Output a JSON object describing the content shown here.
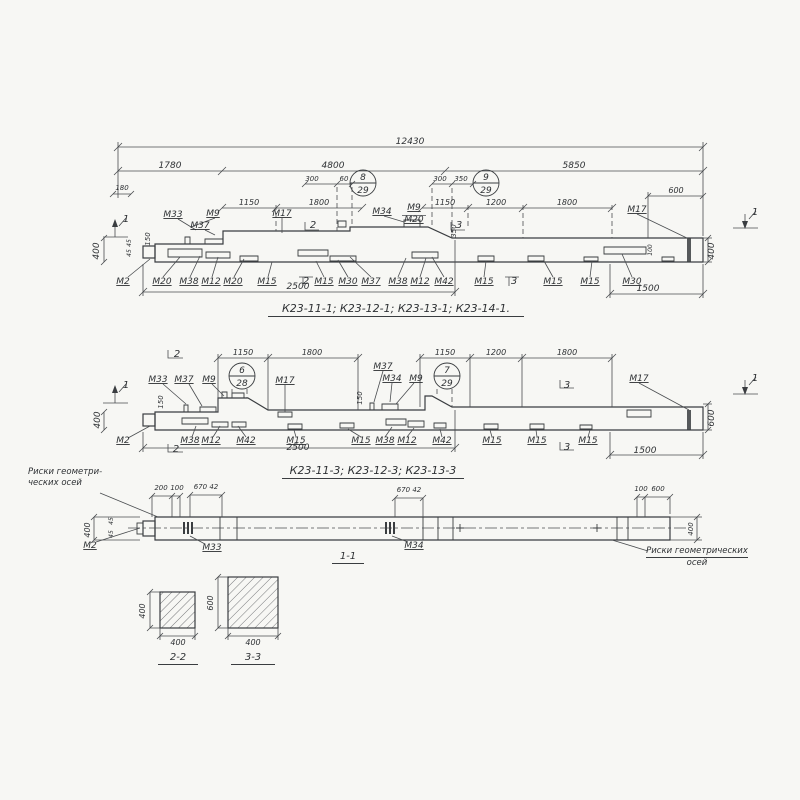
{
  "page": {
    "background": "#f7f7f4",
    "ink": "#3a3d40"
  },
  "captions": {
    "view1": "К23-11-1; К23-12-1; К23-13-1; К23-14-1.",
    "view2": "К23-11-3; К23-12-3; К23-13-3",
    "view3": "1-1",
    "sec2": "2-2",
    "sec3": "3-3"
  },
  "notes": {
    "left1": "Риски геометри-",
    "left2": "ческих осей",
    "right1": "Риски геометрических",
    "right2": "осей"
  },
  "detail_circles": [
    {
      "top": "8",
      "bottom": "29",
      "x": 363,
      "y": 183
    },
    {
      "top": "9",
      "bottom": "29",
      "x": 486,
      "y": 183
    },
    {
      "top": "6",
      "bottom": "28",
      "x": 242,
      "y": 376
    },
    {
      "top": "7",
      "bottom": "29",
      "x": 447,
      "y": 376
    }
  ],
  "labels": [
    {
      "t": "12430",
      "x": 410,
      "y": 144
    },
    {
      "t": "1780",
      "x": 170,
      "y": 168
    },
    {
      "t": "4800",
      "x": 333,
      "y": 168
    },
    {
      "t": "5850",
      "x": 574,
      "y": 168
    },
    {
      "t": "180",
      "x": 122,
      "y": 190,
      "s": 7
    },
    {
      "t": "300",
      "x": 312,
      "y": 181,
      "s": 7
    },
    {
      "t": "60",
      "x": 344,
      "y": 181,
      "s": 7
    },
    {
      "t": "300",
      "x": 440,
      "y": 181,
      "s": 7
    },
    {
      "t": "350",
      "x": 461,
      "y": 181,
      "s": 7
    },
    {
      "t": "1150",
      "x": 249,
      "y": 205,
      "s": 8
    },
    {
      "t": "1800",
      "x": 319,
      "y": 205,
      "s": 8
    },
    {
      "t": "1150",
      "x": 445,
      "y": 205,
      "s": 8
    },
    {
      "t": "1200",
      "x": 496,
      "y": 205,
      "s": 8
    },
    {
      "t": "1800",
      "x": 567,
      "y": 205,
      "s": 8
    },
    {
      "t": "600",
      "x": 676,
      "y": 193,
      "s": 8
    },
    {
      "t": "М33",
      "x": 173,
      "y": 217,
      "u": 1
    },
    {
      "t": "М37",
      "x": 200,
      "y": 228,
      "u": 1
    },
    {
      "t": "М9",
      "x": 213,
      "y": 216,
      "u": 1
    },
    {
      "t": "М17",
      "x": 282,
      "y": 216,
      "u": 1
    },
    {
      "t": "М34",
      "x": 382,
      "y": 214,
      "u": 1
    },
    {
      "t": "М9",
      "x": 414,
      "y": 210,
      "u": 1
    },
    {
      "t": "М20",
      "x": 414,
      "y": 222,
      "u": 1
    },
    {
      "t": "М17",
      "x": 637,
      "y": 212,
      "u": 1
    },
    {
      "t": "2",
      "x": 313,
      "y": 228,
      "s": 10
    },
    {
      "t": "3",
      "x": 459,
      "y": 228,
      "s": 10
    },
    {
      "t": "1",
      "x": 126,
      "y": 222,
      "s": 10
    },
    {
      "t": "1",
      "x": 755,
      "y": 215,
      "s": 10
    },
    {
      "t": "М2",
      "x": 123,
      "y": 284,
      "u": 1
    },
    {
      "t": "М20",
      "x": 162,
      "y": 284,
      "u": 1
    },
    {
      "t": "М38",
      "x": 189,
      "y": 284,
      "u": 1
    },
    {
      "t": "М12",
      "x": 211,
      "y": 284,
      "u": 1
    },
    {
      "t": "М20",
      "x": 233,
      "y": 284,
      "u": 1
    },
    {
      "t": "М15",
      "x": 267,
      "y": 284,
      "u": 1
    },
    {
      "t": "2",
      "x": 306,
      "y": 284,
      "s": 10
    },
    {
      "t": "М15",
      "x": 324,
      "y": 284,
      "u": 1
    },
    {
      "t": "М30",
      "x": 348,
      "y": 284,
      "u": 1
    },
    {
      "t": "М37",
      "x": 371,
      "y": 284,
      "u": 1
    },
    {
      "t": "М38",
      "x": 398,
      "y": 284,
      "u": 1
    },
    {
      "t": "М12",
      "x": 420,
      "y": 284,
      "u": 1
    },
    {
      "t": "М42",
      "x": 444,
      "y": 284,
      "u": 1
    },
    {
      "t": "М15",
      "x": 484,
      "y": 284,
      "u": 1
    },
    {
      "t": "3",
      "x": 514,
      "y": 284,
      "s": 10
    },
    {
      "t": "М15",
      "x": 553,
      "y": 284,
      "u": 1
    },
    {
      "t": "М15",
      "x": 590,
      "y": 284,
      "u": 1
    },
    {
      "t": "М30",
      "x": 632,
      "y": 284,
      "u": 1
    },
    {
      "t": "2500",
      "x": 298,
      "y": 289
    },
    {
      "t": "1500",
      "x": 648,
      "y": 291
    },
    {
      "t": "400",
      "x": 99,
      "y": 251,
      "r": 1
    },
    {
      "t": "150",
      "x": 150,
      "y": 239,
      "r": 1,
      "s": 7
    },
    {
      "t": "45",
      "x": 131,
      "y": 243,
      "r": 1,
      "s": 6
    },
    {
      "t": "45",
      "x": 131,
      "y": 253,
      "r": 1,
      "s": 6
    },
    {
      "t": "350",
      "x": 456,
      "y": 231,
      "r": 1,
      "s": 7
    },
    {
      "t": "100",
      "x": 652,
      "y": 250,
      "r": 1,
      "s": 6
    },
    {
      "t": "400",
      "x": 714,
      "y": 251,
      "r": 1
    },
    {
      "t": "1150",
      "x": 243,
      "y": 355,
      "s": 8
    },
    {
      "t": "1800",
      "x": 312,
      "y": 355,
      "s": 8
    },
    {
      "t": "1150",
      "x": 445,
      "y": 355,
      "s": 8
    },
    {
      "t": "1200",
      "x": 496,
      "y": 355,
      "s": 8
    },
    {
      "t": "1800",
      "x": 567,
      "y": 355,
      "s": 8
    },
    {
      "t": "2",
      "x": 177,
      "y": 357,
      "s": 10
    },
    {
      "t": "М33",
      "x": 158,
      "y": 382,
      "u": 1
    },
    {
      "t": "М37",
      "x": 184,
      "y": 382,
      "u": 1
    },
    {
      "t": "М9",
      "x": 209,
      "y": 382,
      "u": 1
    },
    {
      "t": "М17",
      "x": 285,
      "y": 383,
      "u": 1
    },
    {
      "t": "М37",
      "x": 383,
      "y": 369,
      "u": 1
    },
    {
      "t": "М34",
      "x": 392,
      "y": 381,
      "u": 1
    },
    {
      "t": "М9",
      "x": 416,
      "y": 381,
      "u": 1
    },
    {
      "t": "3",
      "x": 567,
      "y": 388,
      "s": 10
    },
    {
      "t": "М17",
      "x": 639,
      "y": 381,
      "u": 1
    },
    {
      "t": "1",
      "x": 126,
      "y": 388,
      "s": 10
    },
    {
      "t": "1",
      "x": 755,
      "y": 381,
      "s": 10
    },
    {
      "t": "М2",
      "x": 123,
      "y": 443,
      "u": 1
    },
    {
      "t": "2",
      "x": 176,
      "y": 452,
      "s": 10
    },
    {
      "t": "М38",
      "x": 190,
      "y": 443,
      "u": 1
    },
    {
      "t": "М12",
      "x": 211,
      "y": 443,
      "u": 1
    },
    {
      "t": "М42",
      "x": 246,
      "y": 443,
      "u": 1
    },
    {
      "t": "М15",
      "x": 296,
      "y": 443,
      "u": 1
    },
    {
      "t": "М15",
      "x": 361,
      "y": 443,
      "u": 1
    },
    {
      "t": "М38",
      "x": 385,
      "y": 443,
      "u": 1
    },
    {
      "t": "М12",
      "x": 407,
      "y": 443,
      "u": 1
    },
    {
      "t": "М42",
      "x": 442,
      "y": 443,
      "u": 1
    },
    {
      "t": "М15",
      "x": 492,
      "y": 443,
      "u": 1
    },
    {
      "t": "М15",
      "x": 537,
      "y": 443,
      "u": 1
    },
    {
      "t": "3",
      "x": 567,
      "y": 450,
      "s": 10
    },
    {
      "t": "М15",
      "x": 588,
      "y": 443,
      "u": 1
    },
    {
      "t": "2500",
      "x": 298,
      "y": 450
    },
    {
      "t": "1500",
      "x": 645,
      "y": 453
    },
    {
      "t": "400",
      "x": 100,
      "y": 420,
      "r": 1
    },
    {
      "t": "150",
      "x": 163,
      "y": 402,
      "r": 1,
      "s": 7
    },
    {
      "t": "150",
      "x": 362,
      "y": 398,
      "r": 1,
      "s": 7
    },
    {
      "t": "600",
      "x": 714,
      "y": 418,
      "r": 1
    },
    {
      "t": "200",
      "x": 161,
      "y": 490,
      "s": 7
    },
    {
      "t": "100",
      "x": 177,
      "y": 490,
      "s": 7
    },
    {
      "t": "670 42",
      "x": 206,
      "y": 489,
      "s": 7
    },
    {
      "t": "670 42",
      "x": 409,
      "y": 492,
      "s": 7
    },
    {
      "t": "100",
      "x": 641,
      "y": 491,
      "s": 7
    },
    {
      "t": "600",
      "x": 658,
      "y": 491,
      "s": 7
    },
    {
      "t": "М2",
      "x": 90,
      "y": 548,
      "u": 1
    },
    {
      "t": "М33",
      "x": 212,
      "y": 550,
      "u": 1
    },
    {
      "t": "М34",
      "x": 414,
      "y": 548,
      "u": 1
    },
    {
      "t": "400",
      "x": 90,
      "y": 530,
      "r": 1,
      "s": 8
    },
    {
      "t": "45",
      "x": 113,
      "y": 521,
      "r": 1,
      "s": 6
    },
    {
      "t": "45",
      "x": 113,
      "y": 534,
      "r": 1,
      "s": 6
    },
    {
      "t": "400",
      "x": 693,
      "y": 529,
      "r": 1,
      "s": 7
    },
    {
      "t": "400",
      "x": 145,
      "y": 611,
      "r": 1,
      "s": 8
    },
    {
      "t": "400",
      "x": 178,
      "y": 645,
      "s": 8
    },
    {
      "t": "600",
      "x": 213,
      "y": 603,
      "r": 1,
      "s": 8
    },
    {
      "t": "400",
      "x": 253,
      "y": 645,
      "s": 8
    }
  ]
}
